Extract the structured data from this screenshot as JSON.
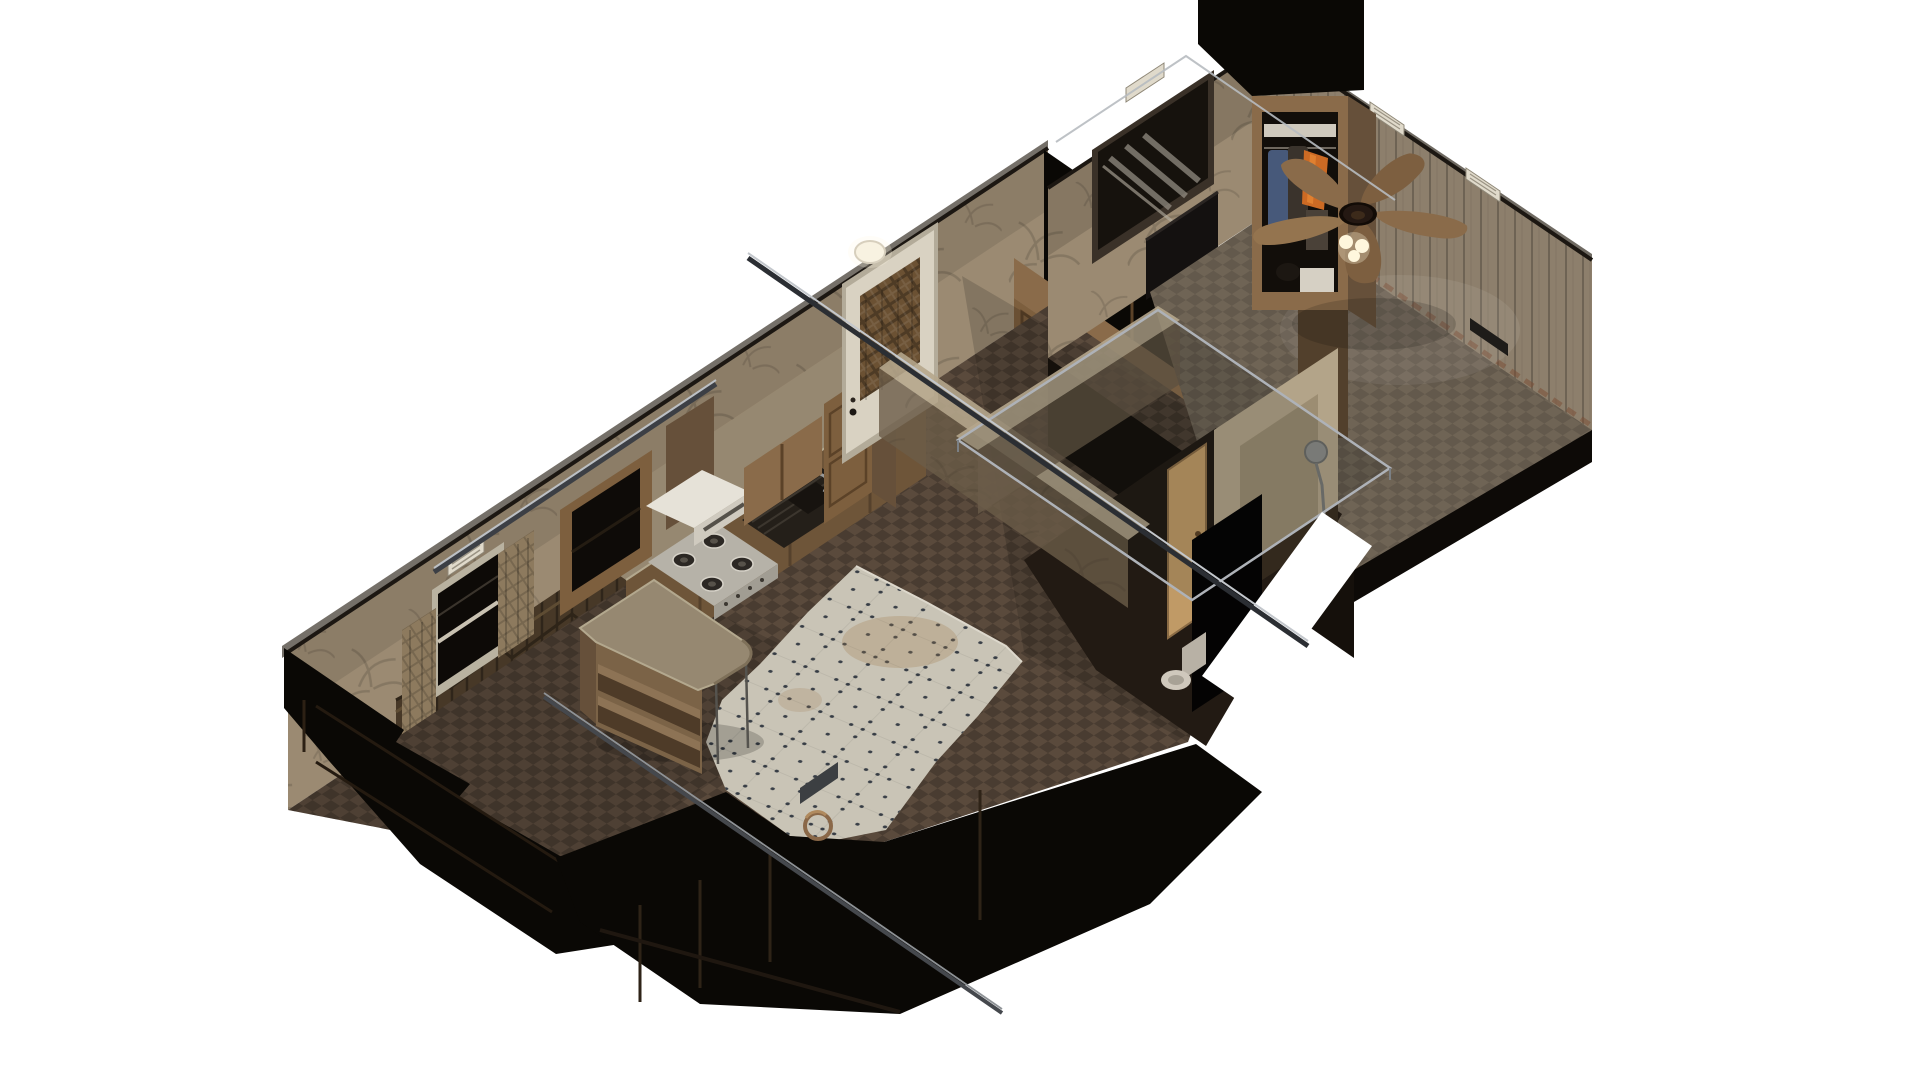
{
  "meta": {
    "view": "isometric cutaway dollhouse render",
    "setting": "single-wide trailer home interior on white background",
    "rendered_text": "none"
  },
  "palette": {
    "bg": "#ffffff",
    "wallpaper": "#9b8a72",
    "wallpaperShade": "#756450",
    "palmLine": "#00000022",
    "wood": "#8a6b4a",
    "woodDark": "#66503a",
    "woodMid": "#7d5f3e",
    "woodFrame": "#5b4228",
    "woodLight": "#a0794f",
    "counter": "#968871",
    "counterSide": "#6e5539",
    "carpet": "#4f4134",
    "carpetHall": "#5a4a3c",
    "bedroomCarpet": "#6f6455",
    "paneling": "#8d7f6c",
    "plankLine": "#6e6254",
    "tile": "#c9c4b6",
    "tileDot": "#3a4048",
    "tileStain": "#a07c50",
    "black": "#0a0805",
    "nearBlack": "#15100b",
    "glassLight": "#bcc0c5",
    "glassDark": "#33363b",
    "hood": "#e6e2d8",
    "hoodFront": "#cfcabf",
    "cooktop": "#b6b2a8",
    "burner": "#2c2824",
    "sinkDark": "#241f19",
    "doorWhite": "#d9d2c2",
    "plaidCurtain": "#6b5133",
    "windowCurtain": "#8d7a5e",
    "wainscot": "#473827",
    "ghostWall": "#6b5c49",
    "ghostLip": "#b5a68c",
    "showerBeige": "#b3a489",
    "showerShade": "#9c8d72",
    "doorTan": "#c09a66",
    "toiletWhite": "#cfc8bc",
    "lampWhite": "#f6f0e0",
    "fanBlade": "#8a6b4a",
    "fanBladeAlt": "#7d5f40",
    "fanBladeLight": "#94744f",
    "fanHub": "#241812",
    "fanLight": "#fff7dd",
    "denim": "#47597a",
    "jacket": "#3a332c",
    "vestOrange": "#cc6a24",
    "vestHi": "#e08030",
    "boxWhite": "#d6d0c4",
    "ventWhite": "#e0dacb",
    "rust": "#7a4c33",
    "steel": "#8e8e8a"
  },
  "scene": {
    "sections": [
      {
        "name": "main-trailer-section",
        "rooms": [
          {
            "name": "kitchen",
            "floor": "worn white tile with dark dot clusters and stains",
            "objects": [
              "gas-cooktop-4-burners",
              "white-range-hood",
              "wood-hood-chimney",
              "sink-with-faucet",
              "counter-run",
              "open-upper-cabinet",
              "upper-cabinets",
              "tall-cabinet",
              "island-bar-with-shelves"
            ]
          },
          {
            "name": "living-area",
            "floor": "brown checkered carpet",
            "objects": [
              "window-with-tan-curtains",
              "wall-vent",
              "water-stain",
              "wood-wainscot",
              "front-door-white-with-plaid-curtain",
              "ceiling-lamp",
              "round-wood-frame",
              "dark-cut-front-walls"
            ]
          },
          {
            "name": "hallway",
            "objects": [
              "wood-closet-door-bank",
              "upper-cabinet-row",
              "black-ceiling-band"
            ]
          },
          {
            "name": "bathroom",
            "objects": [
              "ghost-cut-walls",
              "glass-frame-box",
              "shower-stall",
              "shower-head",
              "tan-door",
              "dark-panel",
              "toilet"
            ]
          }
        ]
      },
      {
        "name": "bedroom-section",
        "rooms": [
          {
            "name": "bedroom",
            "floor": "gray-brown carpet",
            "objects": [
              "palm-wallpaper-wall",
              "curtained-window",
              "tv-on-stand",
              "wood-paneled-wall",
              "wall-vents-white",
              "floor-vent-dark",
              "rusty-baseboard",
              "open-closet-with-clothes",
              "ceiling-fan-5-blades-with-lights",
              "black-ceiling-wedge"
            ]
          }
        ]
      }
    ],
    "closet_contents": [
      "denim jeans",
      "dark jackets",
      "orange safety vest",
      "white shelf boxes",
      "boots"
    ],
    "details": {
      "fan_blade_count": 5,
      "cooktop_burner_count": 4,
      "projection": "dimetric ~34 degrees"
    }
  }
}
